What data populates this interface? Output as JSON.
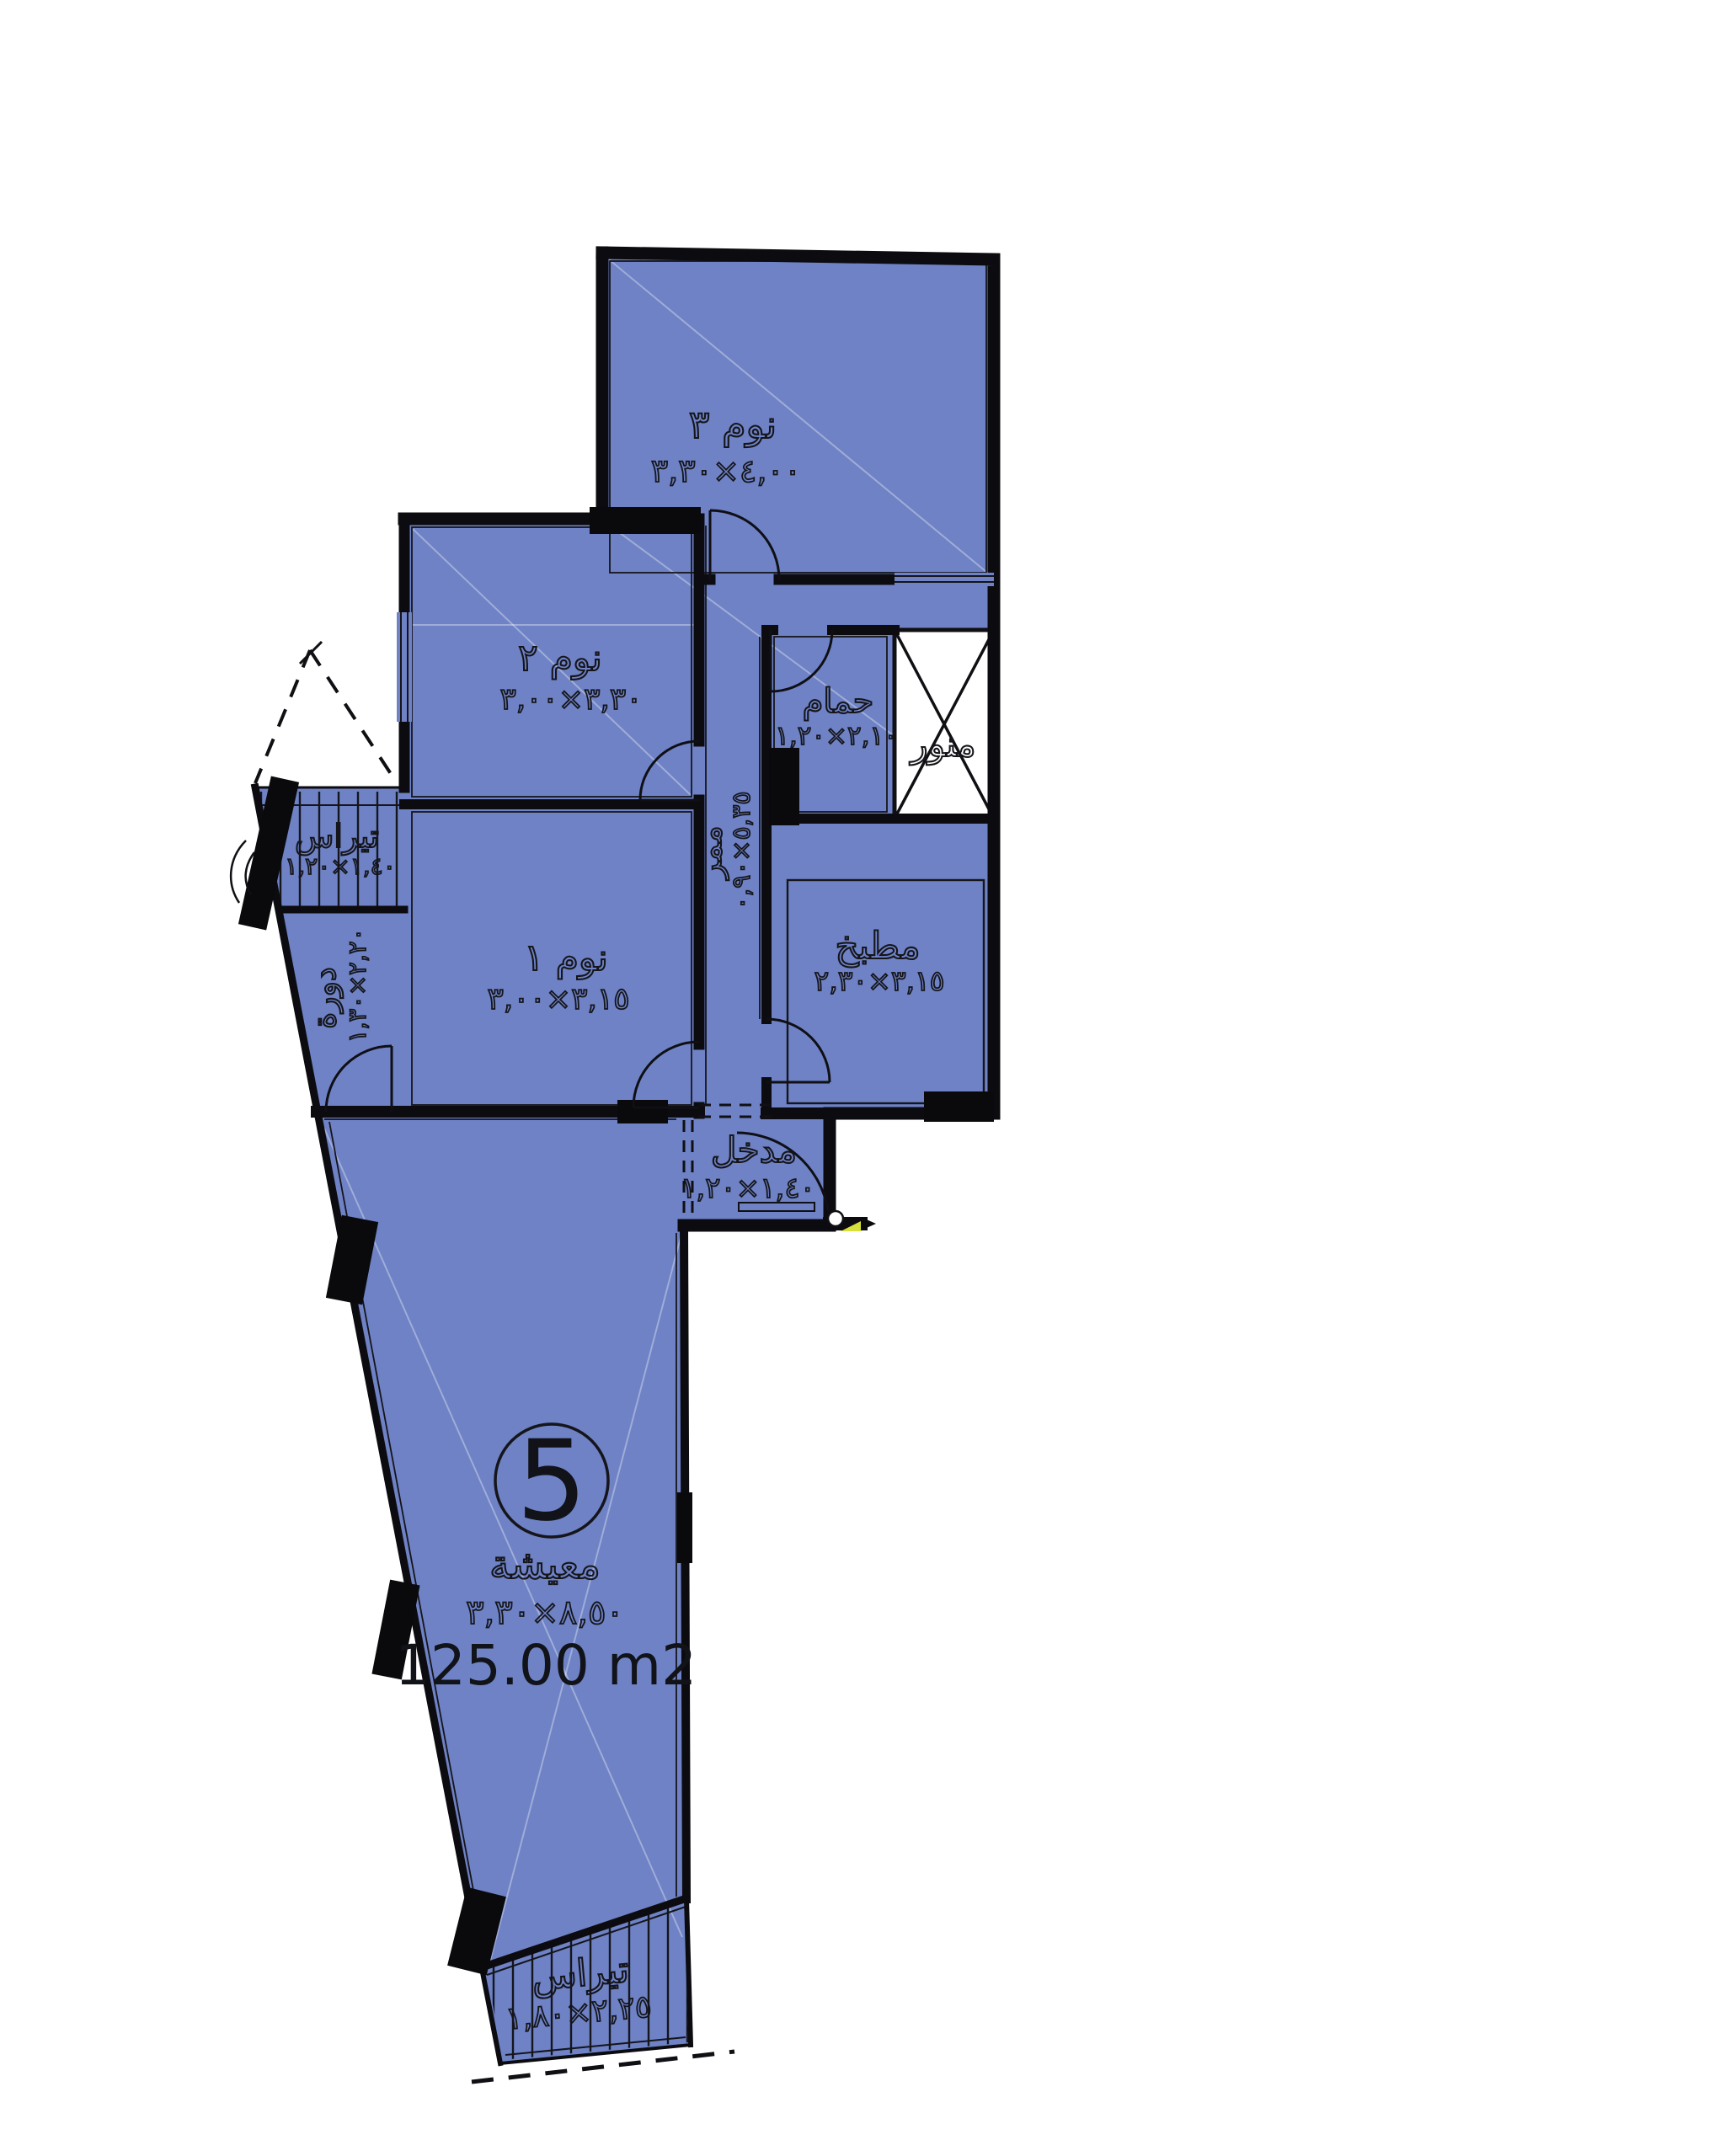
{
  "plan": {
    "unit_number": "5",
    "total_area": "125.00 m2",
    "colors": {
      "floor_fill": "#6e82c5",
      "wall": "#0c0c10",
      "background": "#ffffff",
      "knob_accent": "#d8e03c"
    },
    "rooms": [
      {
        "id": "bedroom3",
        "label": "نوم ٣",
        "dimensions": "٤,٠٠×٣,٣٠"
      },
      {
        "id": "bedroom2",
        "label": "نوم ٢",
        "dimensions": "٣,٣٠×٣,٠٠"
      },
      {
        "id": "bathroom",
        "label": "حمام",
        "dimensions": "٢,١٠×١,٢٠"
      },
      {
        "id": "lightwell",
        "label": "منور",
        "dimensions": ""
      },
      {
        "id": "corridor",
        "label": "ممر",
        "dimensions": "٥,٣٥×٠,٩٠"
      },
      {
        "id": "kitchen",
        "label": "مطبخ",
        "dimensions": "٣,١٥×٢,٣٠"
      },
      {
        "id": "bedroom1",
        "label": "نوم ١",
        "dimensions": "٣,١٥×٣,٠٠"
      },
      {
        "id": "terrace_upper",
        "label": "تيراس",
        "dimensions": "١,٤٠×١,٢٠"
      },
      {
        "id": "wc",
        "label": "دورة",
        "dimensions": "٢,٢٠×١,٣٠"
      },
      {
        "id": "entrance",
        "label": "مدخل",
        "dimensions": "١,٤٠×١,٢٠"
      },
      {
        "id": "living",
        "label": "معيشة",
        "dimensions": "٨,٥٠×٣,٣٠"
      },
      {
        "id": "terrace_lower",
        "label": "تيراس",
        "dimensions": "٢,٢٥×١,٨٠"
      }
    ]
  }
}
